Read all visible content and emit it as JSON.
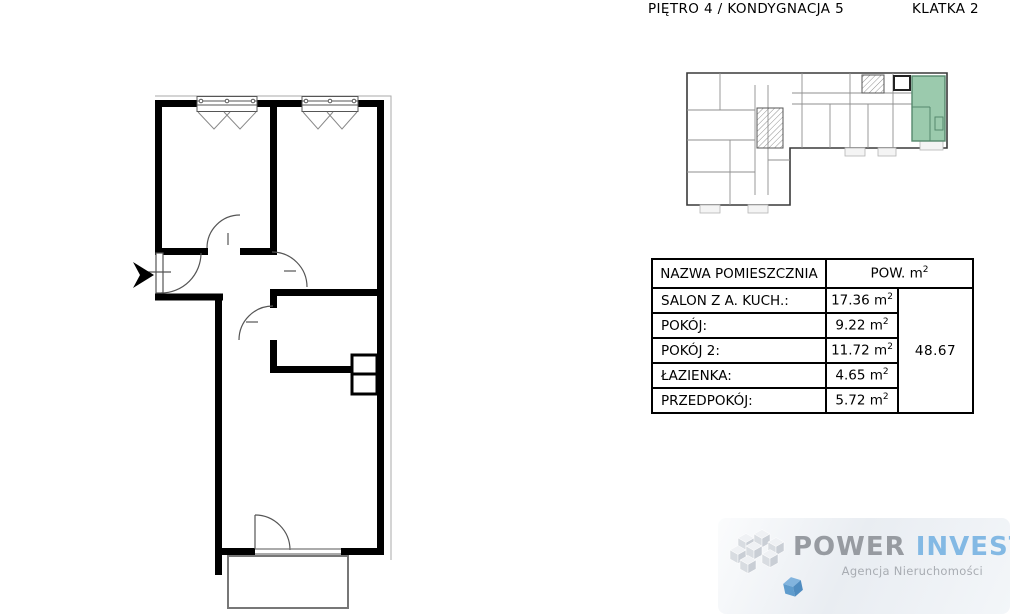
{
  "header": {
    "floor_label": "PIĘTRO 4 / KONDYGNACJA 5",
    "staircase_label": "KLATKA 2"
  },
  "table": {
    "name_header": "NAZWA POMIESZCZNIA",
    "area_header": "POW. m",
    "sup": "2",
    "unit": "m",
    "rows": [
      {
        "label": "SALON Z A. KUCH.:",
        "value": "17.36"
      },
      {
        "label": "POKÓJ:",
        "value": "9.22"
      },
      {
        "label": "POKÓJ 2:",
        "value": "11.72"
      },
      {
        "label": "ŁAZIENKA:",
        "value": "4.65"
      },
      {
        "label": "PRZEDPOKÓJ:",
        "value": "5.72"
      }
    ],
    "total": "48.67",
    "accent_green": "#3fa47e"
  },
  "overview": {
    "highlight_green": "#9bcaad",
    "highlight_border": "#56886d"
  },
  "logo": {
    "brand_part1": "POWER",
    "brand_part2": "INVEST",
    "subtitle": "Agencja Nieruchomości",
    "brand_gray": "#979ba1",
    "brand_blue": "#83b9e4",
    "cube_blue": "#5f9ccd"
  }
}
